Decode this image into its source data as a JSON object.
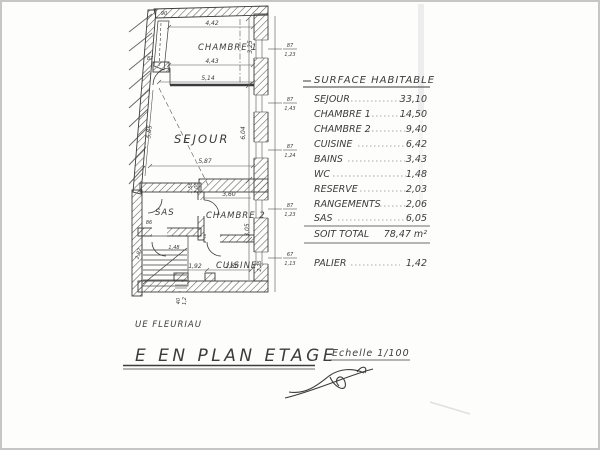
{
  "table": {
    "header": "SURFACE HABITABLE",
    "rows": [
      {
        "label": "SEJOUR",
        "value": "33,10"
      },
      {
        "label": "CHAMBRE 1",
        "value": "14,50"
      },
      {
        "label": "CHAMBRE 2",
        "value": "9,40"
      },
      {
        "label": "CUISINE",
        "value": "6,42"
      },
      {
        "label": "BAINS",
        "value": "3,43"
      },
      {
        "label": "WC",
        "value": "1,48"
      },
      {
        "label": "RESERVE",
        "value": "2,03"
      },
      {
        "label": "RANGEMENTS",
        "value": "2,06"
      },
      {
        "label": "SAS",
        "value": "6,05"
      }
    ],
    "total": {
      "label": "SOIT TOTAL",
      "value": "78,47 m²"
    },
    "palier": {
      "label": "PALIER",
      "value": "1,42"
    }
  },
  "plan": {
    "rooms": {
      "chambre1": "CHAMBRE 1",
      "sejour": "SEJOUR",
      "sas": "SAS",
      "chambre2": "CHAMBRE 2",
      "cuisine": "CUISINE"
    },
    "dims": {
      "top_width": "4,42",
      "chambre1_width": "4,43",
      "chambre1_total": "5,14",
      "chambre1_depth": "3,25",
      "sejour_left": "5,85",
      "sejour_depth": "6,04",
      "sejour_width": "5,87",
      "chambre2_width": "3,60",
      "chambre2_depth": "3,05",
      "cuisine_left": "1,92",
      "cuisine_width": "2,80",
      "cuisine_depth": "2,25",
      "sas_door_w": "1,56",
      "sas_door_h": "2,00",
      "corner": "90",
      "door_left": "87",
      "left_a": "86",
      "left_b": "2,92",
      "left_c": "1,48",
      "bottom_win_w": "40",
      "bottom_win_h": "1,2"
    },
    "windows": [
      {
        "w": "87",
        "h": "1,23"
      },
      {
        "w": "87",
        "h": "1,43"
      },
      {
        "w": "87",
        "h": "1,24"
      },
      {
        "w": "87",
        "h": "1,23"
      },
      {
        "w": "67",
        "h": "1,13"
      }
    ]
  },
  "footer": {
    "street": "UE FLEURIAU",
    "title": "E EN PLAN ETAGE",
    "scale": "Echelle 1/100"
  }
}
